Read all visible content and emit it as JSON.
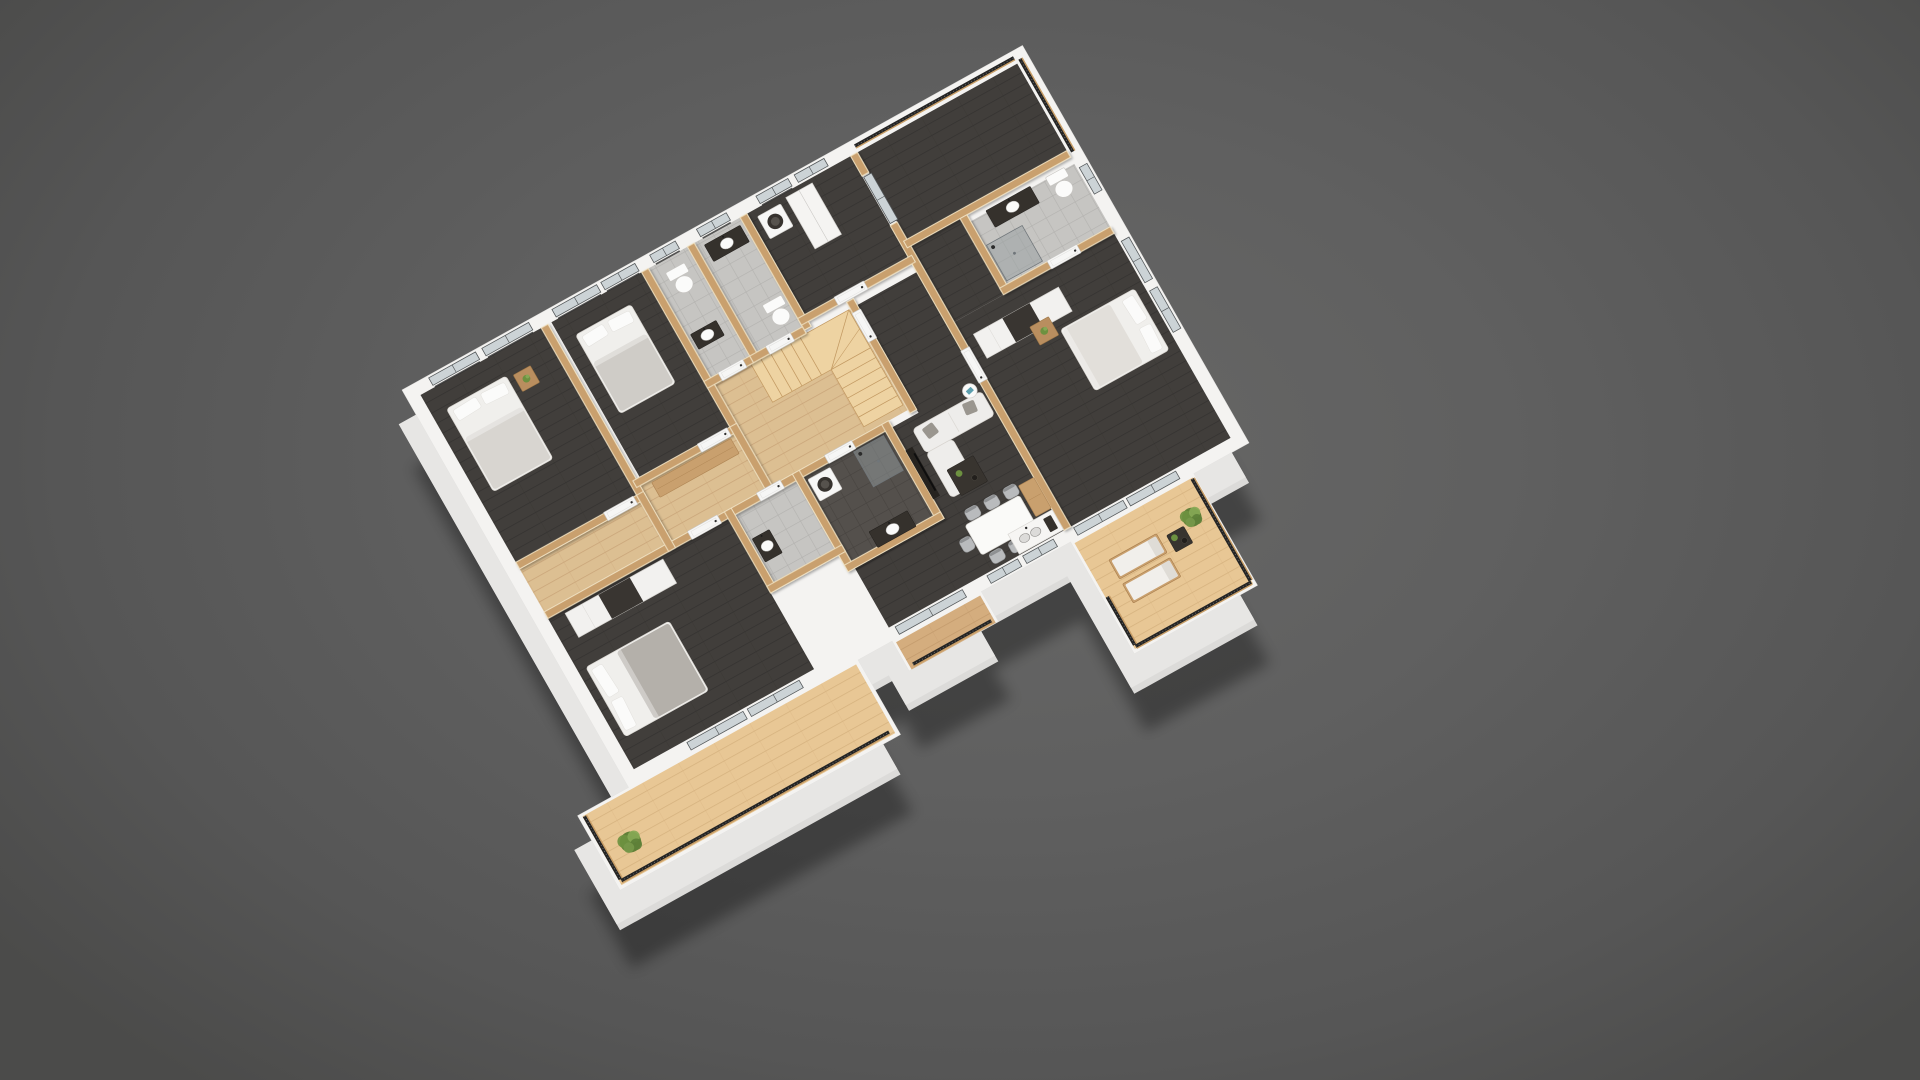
{
  "scene": {
    "description": "3D cutaway floor plan render of an apartment viewed from above at an angle",
    "background": {
      "center": "#676766",
      "edge": "#4b4b4a"
    },
    "matrix": [
      0.425,
      -0.236,
      0.236,
      0.414,
      402,
      390
    ],
    "base_offset": 40,
    "shadow_offset": 78
  },
  "palette": {
    "wall_top": "#f4f3f1",
    "wall_face": "#dcdbd9",
    "wood_wall": "#c9a06e",
    "wood_wall_edge": "#efe0c0",
    "floor_dark": "#413e3b",
    "floor_dark_line": "#343230",
    "floor_light": "#dcbf92",
    "floor_light_line": "#c9a478",
    "deck": "#e8c795",
    "deck_line": "#d5b17e",
    "deck_dark": "#d4ad7e",
    "deck_dark_line": "#c29a6b",
    "tile": "#c6c5c2",
    "tile_line": "#b2b1ae",
    "dark_tile": "#54504c",
    "dark_tile_line": "#454закрыт340",
    "stair": "#eed3a2",
    "stair_line": "#c39a63",
    "rail_dark": "#242424",
    "rail_wood": "#c89e67",
    "glass": "#ccd3d6",
    "glass_frame": "#54585a",
    "door_white": "#f6f6f5",
    "furn_white": "#f0efec",
    "pillow_gray": "#9a968f",
    "furn_dark": "#38342f",
    "plant_green": "#6d9140"
  },
  "rooms_legend": [
    "bedroom-1",
    "bedroom-2",
    "wc-1",
    "bathroom-1",
    "laundry",
    "loggia-balcony",
    "master-bathroom",
    "master-bedroom",
    "hallway",
    "closet",
    "stairwell",
    "corridor-living",
    "bedroom-3",
    "wc-2",
    "bathroom-2",
    "dining-kitchen",
    "deck-long",
    "balcony-small",
    "terrace"
  ],
  "outline": "M0,0 L1460,0 L1460,960 L1330,960 L1330,1230 L1040,1230 L1040,960 L830,960 L830,1032 L620,1032 L620,960 L540,960 L540,1140 L-120,1140 L-120,960 L0,960 Z",
  "floors": [
    {
      "name": "floor-bedroom-1",
      "fill": "dark",
      "rect": [
        28,
        28,
        284,
        404
      ]
    },
    {
      "name": "floor-bedroom-2",
      "fill": "dark",
      "rect": [
        336,
        28,
        212,
        374
      ]
    },
    {
      "name": "floor-wc-1",
      "fill": "tile",
      "rect": [
        564,
        28,
        92,
        264
      ]
    },
    {
      "name": "floor-bathroom-1",
      "fill": "tile",
      "rect": [
        672,
        28,
        108,
        264
      ]
    },
    {
      "name": "floor-laundry",
      "fill": "dark",
      "rect": [
        796,
        28,
        244,
        244
      ]
    },
    {
      "name": "floor-loggia",
      "fill": "dark",
      "rect": [
        1056,
        28,
        376,
        210
      ]
    },
    {
      "name": "floor-master-bathroom",
      "fill": "tile",
      "rect": [
        1188,
        270,
        244,
        152
      ]
    },
    {
      "name": "floor-master-entry",
      "fill": "dark",
      "rect": [
        1056,
        254,
        116,
        184
      ]
    },
    {
      "name": "floor-master-bedroom",
      "fill": "dark",
      "rect": [
        1056,
        438,
        376,
        494
      ]
    },
    {
      "name": "floor-hallway",
      "fill": "light",
      "path": "M28,448 L312,448 L312,418 L548,418 L548,308 L884,308 L884,552 L28,552 Z"
    },
    {
      "name": "floor-closet",
      "fill": "light",
      "rect": [
        328,
        418,
        220,
        134
      ]
    },
    {
      "name": "floor-corridor-living",
      "fill": "dark",
      "path": "M900,308 L1040,308 L1040,932 L628,932 L628,788 L838,788 L838,568 L900,568 Z"
    },
    {
      "name": "floor-bedroom-3",
      "fill": "dark",
      "rect": [
        28,
        568,
        424,
        364
      ]
    },
    {
      "name": "floor-wc-2",
      "fill": "tile",
      "rect": [
        468,
        568,
        144,
        164
      ]
    },
    {
      "name": "floor-bathroom-2",
      "fill": "darktile",
      "rect": [
        628,
        568,
        194,
        204
      ]
    },
    {
      "name": "floor-deck-long",
      "fill": "deck",
      "rect": [
        -112,
        966,
        644,
        166
      ]
    },
    {
      "name": "floor-balcony-small",
      "fill": "deckdark",
      "rect": [
        626,
        966,
        198,
        66
      ]
    },
    {
      "name": "floor-terrace",
      "fill": "deck",
      "rect": [
        1046,
        966,
        278,
        256
      ]
    }
  ],
  "walls": [
    [
      312,
      28,
      16,
      412
    ],
    [
      28,
      432,
      284,
      16
    ],
    [
      548,
      28,
      16,
      382
    ],
    [
      320,
      402,
      228,
      16
    ],
    [
      656,
      28,
      16,
      272
    ],
    [
      548,
      292,
      108,
      16
    ],
    [
      780,
      28,
      16,
      272
    ],
    [
      656,
      292,
      124,
      16
    ],
    [
      1040,
      28,
      16,
      48
    ],
    [
      1040,
      196,
      16,
      736
    ],
    [
      780,
      272,
      268,
      16
    ],
    [
      1048,
      238,
      384,
      16
    ],
    [
      1172,
      254,
      16,
      176
    ],
    [
      1172,
      422,
      260,
      16
    ],
    [
      884,
      292,
      16,
      268
    ],
    [
      28,
      552,
      810,
      16
    ],
    [
      612,
      552,
      16,
      236
    ],
    [
      822,
      552,
      16,
      236
    ],
    [
      612,
      772,
      226,
      16
    ],
    [
      452,
      552,
      16,
      196
    ],
    [
      452,
      732,
      176,
      16
    ],
    [
      312,
      432,
      16,
      136
    ],
    [
      548,
      402,
      16,
      166
    ]
  ],
  "windows": [
    {
      "name": "window-bedroom1-a",
      "o": "h",
      "x": 60,
      "y": 5,
      "len": 110,
      "rail": true
    },
    {
      "name": "window-bedroom1-b",
      "o": "h",
      "x": 185,
      "y": 5,
      "len": 110,
      "rail": true
    },
    {
      "name": "window-bedroom2-a",
      "o": "h",
      "x": 350,
      "y": 5,
      "len": 105,
      "rail": true
    },
    {
      "name": "window-bedroom2-b",
      "o": "h",
      "x": 465,
      "y": 5,
      "len": 80,
      "rail": true
    },
    {
      "name": "window-wc1",
      "o": "h",
      "x": 580,
      "y": 5,
      "len": 60,
      "rail": true
    },
    {
      "name": "window-bathroom1",
      "o": "h",
      "x": 690,
      "y": 5,
      "len": 70,
      "rail": true
    },
    {
      "name": "window-laundry-a",
      "o": "h",
      "x": 830,
      "y": 5,
      "len": 75,
      "rail": true
    },
    {
      "name": "window-laundry-b",
      "o": "h",
      "x": 920,
      "y": 5,
      "len": 70,
      "rail": false
    },
    {
      "name": "window-master-a",
      "o": "v",
      "x": 1437,
      "y": 460,
      "len": 100,
      "rail": false
    },
    {
      "name": "window-master-b",
      "o": "v",
      "x": 1437,
      "y": 580,
      "len": 100,
      "rail": false
    },
    {
      "name": "window-master-bath",
      "o": "v",
      "x": 1437,
      "y": 282,
      "len": 64,
      "rail": false
    },
    {
      "name": "glass-door-bedroom3-a",
      "o": "h",
      "x": 150,
      "y": 937,
      "len": 132,
      "rail": false
    },
    {
      "name": "glass-door-bedroom3-b",
      "o": "h",
      "x": 292,
      "y": 937,
      "len": 122,
      "rail": false
    },
    {
      "name": "window-living-a",
      "o": "h",
      "x": 856,
      "y": 937,
      "len": 72,
      "rail": false
    },
    {
      "name": "window-living-b",
      "o": "h",
      "x": 940,
      "y": 937,
      "len": 72,
      "rail": false
    },
    {
      "name": "slider-balcony-small",
      "o": "h",
      "x": 640,
      "y": 937,
      "len": 158,
      "rail": false
    },
    {
      "name": "slider-terrace-a",
      "o": "h",
      "x": 1060,
      "y": 937,
      "len": 116,
      "rail": false
    },
    {
      "name": "slider-terrace-b",
      "o": "h",
      "x": 1184,
      "y": 937,
      "len": 116,
      "rail": false
    },
    {
      "name": "slider-loggia",
      "o": "v",
      "x": 1042,
      "y": 80,
      "len": 112,
      "rail": false
    }
  ],
  "doors": [
    {
      "name": "door-bedroom-1",
      "o": "h",
      "x": 235,
      "y": 432,
      "len": 70
    },
    {
      "name": "door-bedroom-2",
      "o": "h",
      "x": 472,
      "y": 402,
      "len": 70
    },
    {
      "name": "door-wc-1",
      "o": "h",
      "x": 582,
      "y": 292,
      "len": 58
    },
    {
      "name": "door-bathroom-1",
      "o": "h",
      "x": 694,
      "y": 292,
      "len": 58
    },
    {
      "name": "door-laundry",
      "o": "h",
      "x": 866,
      "y": 272,
      "len": 70
    },
    {
      "name": "door-hall-corridor",
      "o": "v",
      "x": 884,
      "y": 318,
      "len": 70
    },
    {
      "name": "door-bedroom-3",
      "o": "h",
      "x": 366,
      "y": 552,
      "len": 70
    },
    {
      "name": "door-wc-2",
      "o": "h",
      "x": 528,
      "y": 552,
      "len": 56
    },
    {
      "name": "door-bathroom-2",
      "o": "h",
      "x": 688,
      "y": 552,
      "len": 64
    },
    {
      "name": "door-master",
      "o": "v",
      "x": 1040,
      "y": 498,
      "len": 78
    },
    {
      "name": "door-master-bath",
      "o": "h",
      "x": 1284,
      "y": 422,
      "len": 70
    }
  ],
  "railings": [
    {
      "name": "railing-loggia-top",
      "o": "h",
      "x": 1058,
      "y": 10,
      "len": 374
    },
    {
      "name": "railing-loggia-right",
      "o": "v",
      "x": 1438,
      "y": 22,
      "len": 224
    },
    {
      "name": "railing-deck-front",
      "o": "h",
      "x": -108,
      "y": 1120,
      "len": 630
    },
    {
      "name": "railing-deck-left",
      "o": "v",
      "x": -112,
      "y": 968,
      "len": 152
    },
    {
      "name": "railing-balcony-small",
      "o": "h",
      "x": 634,
      "y": 1020,
      "len": 184
    },
    {
      "name": "railing-terrace-front",
      "o": "h",
      "x": 1050,
      "y": 1214,
      "len": 272
    },
    {
      "name": "railing-terrace-right",
      "o": "v",
      "x": 1318,
      "y": 968,
      "len": 246
    },
    {
      "name": "railing-terrace-left",
      "o": "v",
      "x": 1046,
      "y": 1098,
      "len": 116
    }
  ],
  "stairs": {
    "name": "staircase",
    "x": 650,
    "y": 308,
    "flightAw": 138,
    "depth": 92,
    "flightBh": 138,
    "width": 92
  },
  "furniture": [
    {
      "type": "bed",
      "name": "bed-bedroom-1",
      "x": 60,
      "y": 80,
      "w": 140,
      "h": 200,
      "pillows": "top",
      "blanket": "#d8d5d0"
    },
    {
      "type": "nightstand",
      "name": "nightstand-bedroom-1",
      "x": 214,
      "y": 86,
      "w": 40,
      "h": 40,
      "plant": true
    },
    {
      "type": "bed",
      "name": "bed-bedroom-2",
      "x": 366,
      "y": 76,
      "w": 130,
      "h": 190,
      "pillows": "top",
      "blanket": "#cfccc7"
    },
    {
      "type": "toilet",
      "name": "toilet-wc-1",
      "x": 590,
      "y": 54,
      "w": 44,
      "h": 58
    },
    {
      "type": "sinkv",
      "name": "sink-wc-1",
      "x": 572,
      "y": 192,
      "w": 60,
      "h": 36
    },
    {
      "type": "sinkv",
      "name": "vanity-bathroom-1",
      "x": 688,
      "y": 42,
      "w": 84,
      "h": 40
    },
    {
      "type": "toilet",
      "name": "toilet-bathroom-1",
      "x": 730,
      "y": 212,
      "w": 44,
      "h": 58
    },
    {
      "type": "washer",
      "name": "washing-machine-laundry",
      "x": 812,
      "y": 44,
      "w": 54,
      "h": 54
    },
    {
      "type": "cabinet",
      "name": "tall-cabinet-laundry",
      "x": 882,
      "y": 38,
      "w": 62,
      "h": 124
    },
    {
      "type": "sinkv",
      "name": "vanity-master-bath",
      "x": 1226,
      "y": 266,
      "w": 104,
      "h": 40
    },
    {
      "type": "toilet",
      "name": "toilet-master-bath",
      "x": 1366,
      "y": 266,
      "w": 44,
      "h": 58
    },
    {
      "type": "shower",
      "name": "shower-master-bath",
      "x": 1192,
      "y": 330,
      "w": 84,
      "h": 86
    },
    {
      "type": "bench",
      "name": "closet-bench",
      "x": 352,
      "y": 424,
      "w": 186,
      "h": 36
    },
    {
      "type": "sinkv",
      "name": "sink-wc-2",
      "x": 474,
      "y": 630,
      "w": 40,
      "h": 56
    },
    {
      "type": "washer",
      "name": "washing-machine-bath-2",
      "x": 634,
      "y": 578,
      "w": 52,
      "h": 52
    },
    {
      "type": "shower",
      "name": "shower-bath-2",
      "x": 744,
      "y": 574,
      "w": 70,
      "h": 84
    },
    {
      "type": "sinkv",
      "name": "vanity-bath-2",
      "x": 690,
      "y": 736,
      "w": 90,
      "h": 38
    },
    {
      "type": "wardrobe",
      "name": "wardrobe-bedroom-3",
      "x": 64,
      "y": 576,
      "w": 230,
      "h": 58
    },
    {
      "type": "bed",
      "name": "bed-bedroom-3",
      "x": 46,
      "y": 696,
      "w": 196,
      "h": 168,
      "pillows": "left",
      "blanket": "#b4b0aa"
    },
    {
      "type": "tvunit",
      "name": "tv-media-wall",
      "x": 838,
      "y": 624,
      "w": 16,
      "h": 118
    },
    {
      "type": "sofa",
      "name": "sofa-living",
      "x": 872,
      "y": 592,
      "back": [
        0,
        0,
        162,
        58
      ],
      "chaise": [
        0,
        58,
        62,
        108
      ]
    },
    {
      "type": "roundtable",
      "name": "side-table-living",
      "cx": 1014,
      "cy": 580,
      "r": 15
    },
    {
      "type": "coffeetable",
      "name": "coffee-table-living",
      "x": 892,
      "y": 702,
      "w": 62,
      "h": 62
    },
    {
      "type": "table",
      "name": "dining-table",
      "x": 868,
      "y": 822,
      "w": 128,
      "h": 72
    },
    {
      "type": "chair",
      "name": "dining-chair-1",
      "x": 880,
      "y": 794,
      "w": 30,
      "h": 26
    },
    {
      "type": "chair",
      "name": "dining-chair-2",
      "x": 925,
      "y": 794,
      "w": 30,
      "h": 26
    },
    {
      "type": "chair",
      "name": "dining-chair-3",
      "x": 970,
      "y": 794,
      "w": 30,
      "h": 26
    },
    {
      "type": "chair",
      "name": "dining-chair-4",
      "x": 880,
      "y": 898,
      "w": 30,
      "h": 26
    },
    {
      "type": "chair",
      "name": "dining-chair-5",
      "x": 925,
      "y": 898,
      "w": 30,
      "h": 26
    },
    {
      "type": "chair",
      "name": "dining-chair-6",
      "x": 970,
      "y": 898,
      "w": 30,
      "h": 26
    },
    {
      "type": "chair",
      "name": "dining-chair-7",
      "x": 840,
      "y": 844,
      "w": 26,
      "h": 30
    },
    {
      "type": "counter",
      "name": "kitchen-counter-sink",
      "x": 936,
      "y": 882,
      "w": 104,
      "h": 48
    },
    {
      "type": "bench",
      "name": "kitchen-tall-unit",
      "x": 1004,
      "y": 804,
      "w": 36,
      "h": 74
    },
    {
      "type": "wardrobe",
      "name": "wardrobe-master",
      "x": 1078,
      "y": 480,
      "w": 200,
      "h": 58
    },
    {
      "type": "bed",
      "name": "bed-master",
      "x": 1238,
      "y": 560,
      "w": 174,
      "h": 148,
      "pillows": "right",
      "blanket": "#e2dfda"
    },
    {
      "type": "nightstand",
      "name": "nightstand-master",
      "x": 1186,
      "y": 524,
      "w": 44,
      "h": 44,
      "plant": true
    },
    {
      "type": "lounge",
      "name": "lounge-chair-terrace-1",
      "x": 1090,
      "y": 1032,
      "w": 112,
      "h": 46
    },
    {
      "type": "lounge",
      "name": "lounge-chair-terrace-2",
      "x": 1090,
      "y": 1090,
      "w": 112,
      "h": 46
    },
    {
      "type": "coffeetable",
      "name": "terrace-table",
      "x": 1218,
      "y": 1046,
      "w": 40,
      "h": 40
    },
    {
      "type": "plant",
      "name": "plant-terrace",
      "cx": 1282,
      "cy": 1038,
      "r": 20
    },
    {
      "type": "plant",
      "name": "plant-deck",
      "cx": -52,
      "cy": 1062,
      "r": 22
    }
  ]
}
